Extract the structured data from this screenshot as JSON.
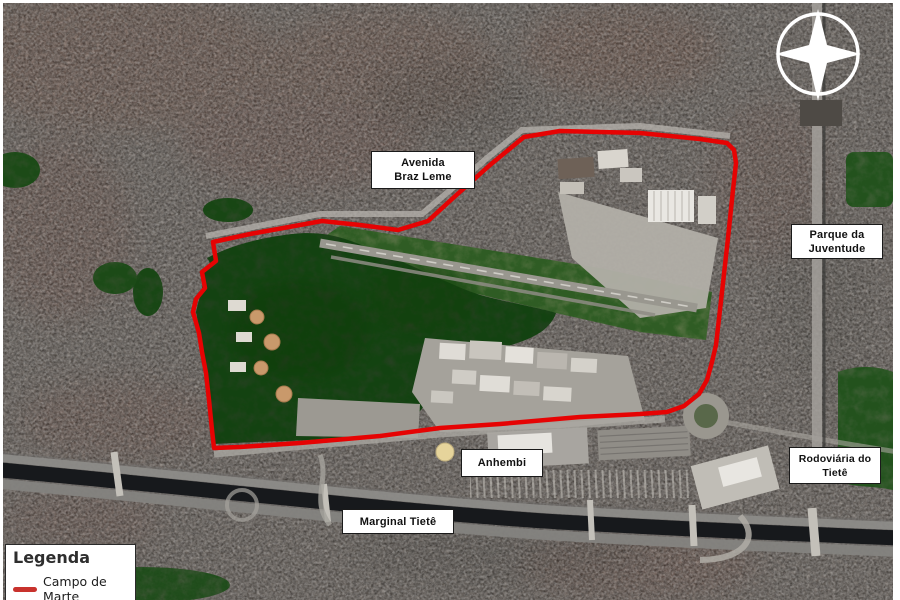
{
  "labels": [
    {
      "id": "avenida-braz-leme",
      "line1": "Avenida",
      "line2": "Braz Leme"
    },
    {
      "id": "parque-da-juventude",
      "line1": "Parque da",
      "line2": "Juventude"
    },
    {
      "id": "anhembi",
      "line1": "Anhembi"
    },
    {
      "id": "rodoviaria-do-tiete",
      "line1": "Rodoviária do",
      "line2": "Tietê"
    },
    {
      "id": "marginal-tiete",
      "line1": "Marginal Tietê"
    }
  ],
  "legend": {
    "title": "Legenda",
    "items": [
      {
        "label": "Campo de Marte",
        "color": "#c8322d"
      }
    ]
  },
  "colors": {
    "boundary": "#e60303",
    "legend_swatch": "#c8322d",
    "forest": "#31402b",
    "river": "#17191c",
    "compass": "#ffffff"
  },
  "icons": {
    "compass": "north-arrow"
  }
}
